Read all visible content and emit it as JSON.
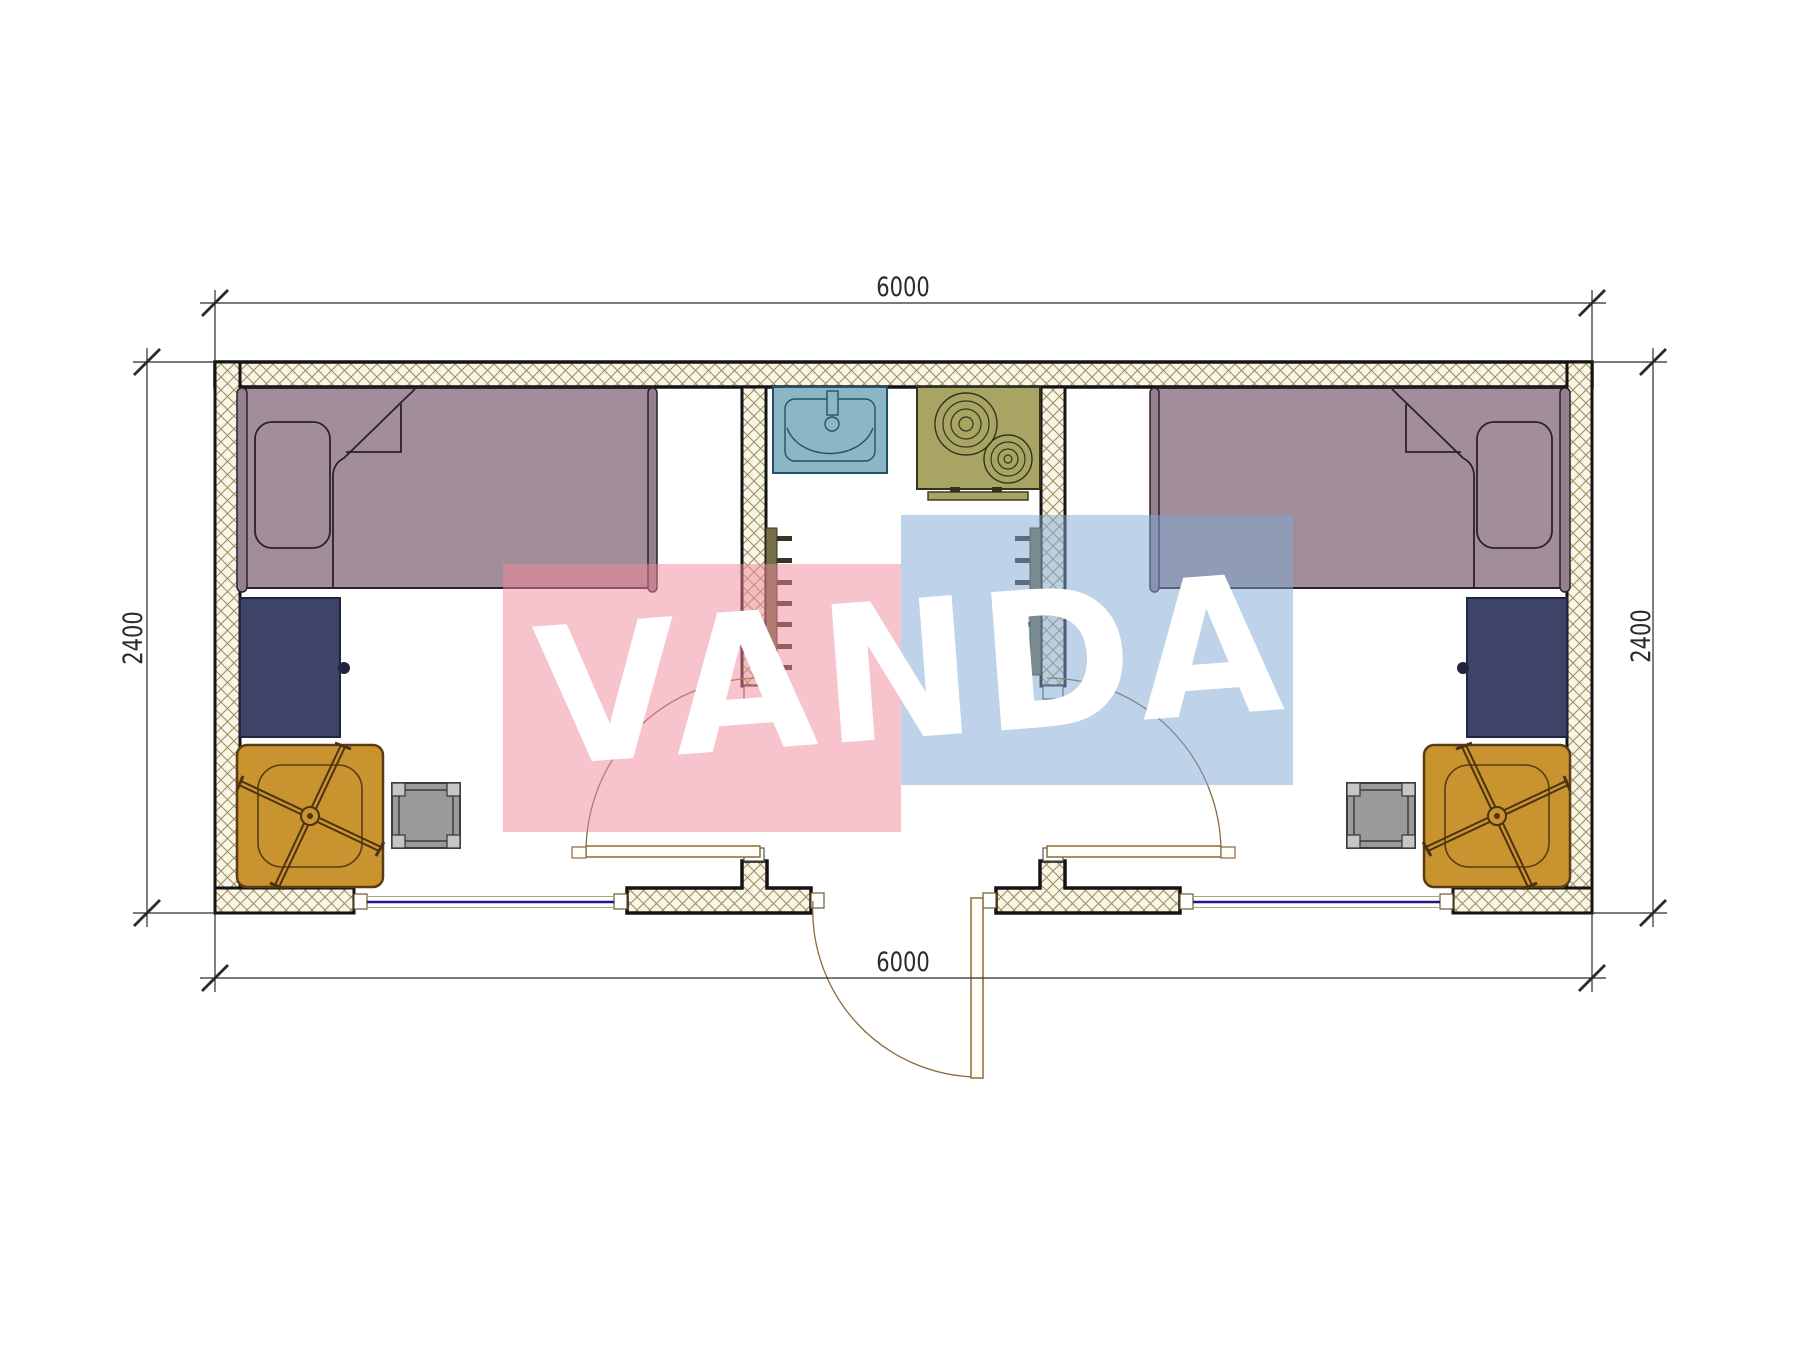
{
  "dimensions": {
    "top": "6000",
    "bottom": "6000",
    "left": "2400",
    "right": "2400"
  },
  "watermark": {
    "text": "VANDA",
    "pink_color": "#ef8799",
    "blue_color": "#7da7d5",
    "text_color": "#ffffff"
  },
  "colors": {
    "wall_outline": "#141414",
    "wall_hatch_line": "#9b8d5a",
    "wall_hatch_bg": "#f8f4e6",
    "bed": "#a28e9b",
    "bed_outline": "#2e1f2b",
    "desk": "#3d4468",
    "chair": "#c9932f",
    "chair_outline": "#5a3c14",
    "stool": "#9a9a9a",
    "sink": "#8cb6c3",
    "sink_outline": "#23506b",
    "stove": "#a8a464",
    "stove_outline": "#33331c",
    "radiator": "#756f48",
    "door": "#8a6b3a",
    "window_glass": "#1a1a8c",
    "dimension_lines": "#2b2b2b"
  },
  "fixtures": {
    "left_room": [
      "bed",
      "pillow",
      "desk",
      "office-chair",
      "stool",
      "door",
      "window"
    ],
    "center": [
      "sink",
      "stove",
      "radiator-left",
      "radiator-right",
      "entrance-door"
    ],
    "right_room": [
      "bed",
      "pillow",
      "desk",
      "office-chair",
      "stool",
      "door",
      "window"
    ]
  }
}
